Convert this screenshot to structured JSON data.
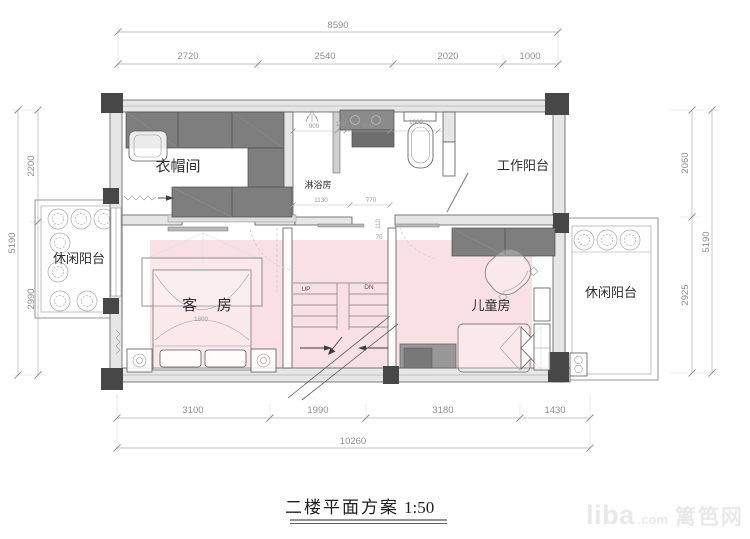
{
  "title": {
    "name": "二楼平面方案",
    "scale": "1:50"
  },
  "watermark": {
    "logo": "liba",
    "tld": ".com",
    "site": "篱笆网"
  },
  "rooms": {
    "cloakroom": "衣帽间",
    "shower": "淋浴房",
    "work_balcony": "工作阳台",
    "leisure_balcony_left": "休闲阳台",
    "leisure_balcony_right": "休闲阳台",
    "guest_room": "客 房",
    "kids_room": "儿童房"
  },
  "stairs": {
    "up": "UP",
    "down": "DN"
  },
  "dimensions": {
    "top": {
      "total": "8590",
      "segments": [
        "2720",
        "2540",
        "2020",
        "1000"
      ]
    },
    "bottom": {
      "total": "10260",
      "segments": [
        "3100",
        "1990",
        "3180",
        "1430"
      ]
    },
    "left": {
      "total": "5190",
      "segments": [
        "2200",
        "2990"
      ]
    },
    "right": {
      "total": "5190",
      "segments": [
        "2060",
        "2925"
      ]
    },
    "interior": {
      "shower_width": "900",
      "counter_gap": "190",
      "counter_width": "900",
      "toilet_bay": "1000",
      "bath_wall": "1130",
      "stair_opening": "770",
      "jamb_width": "110",
      "jamb_depth": "70",
      "bed_width": "1800"
    }
  },
  "colors": {
    "floor_highlight": "#f6dce1",
    "wall_fill": "#e6e6e6",
    "column": "#474747",
    "furniture": "#7e7e7e",
    "dimension_gray": "#8f8f8f"
  }
}
